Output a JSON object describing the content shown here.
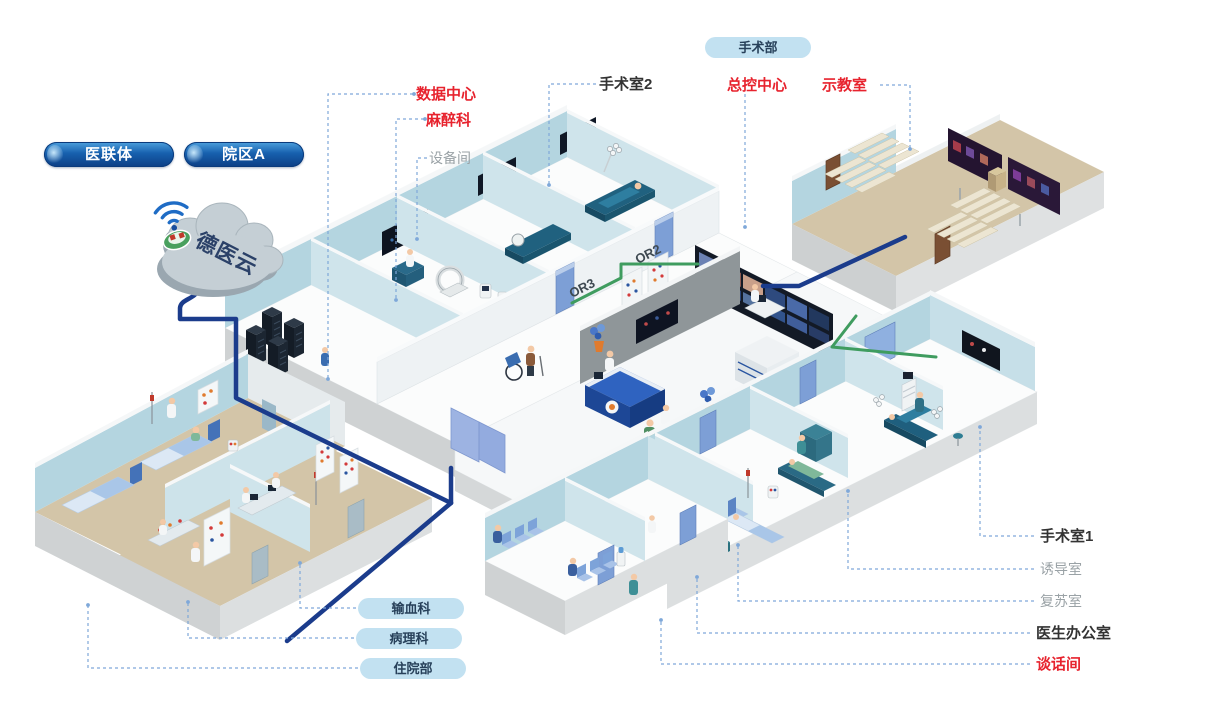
{
  "badges": {
    "network": "医联体",
    "campus": "院区A",
    "department": "手术部"
  },
  "cloud_label": "德医云",
  "labels": {
    "data_center": {
      "text": "数据中心",
      "style": "red"
    },
    "anesthesiology": {
      "text": "麻醉科",
      "style": "red"
    },
    "equipment_room": {
      "text": "设备间",
      "style": "gray"
    },
    "operating_room_2": {
      "text": "手术室2",
      "style": "dark"
    },
    "master_control": {
      "text": "总控中心",
      "style": "red"
    },
    "demo_room": {
      "text": "示教室",
      "style": "red"
    },
    "operating_room_1": {
      "text": "手术室1",
      "style": "dark"
    },
    "induction_room": {
      "text": "诱导室",
      "style": "gray"
    },
    "recovery_room": {
      "text": "复苏室",
      "style": "gray"
    },
    "doctor_office": {
      "text": "医生办公室",
      "style": "dark"
    },
    "talk_room": {
      "text": "谈话间",
      "style": "red"
    }
  },
  "pills": {
    "blood": "输血科",
    "pathology": "病理科",
    "inpatient": "住院部"
  },
  "wall_texts": {
    "or2": "OR2",
    "or3": "OR3"
  },
  "colors": {
    "red_label": "#e7232e",
    "dark_label": "#333333",
    "gray_label": "#9aa2a6",
    "leader": "#7fa8d9",
    "backbone_line": "#1b3c8c",
    "lan_line": "#3f9c5f",
    "pill_bg": "#c2e1f1",
    "pill_text": "#27405a",
    "badge_blue": "#0c3e84",
    "wall_blue": "#b4d5e0",
    "floor_tan": "#d3c5a8"
  }
}
